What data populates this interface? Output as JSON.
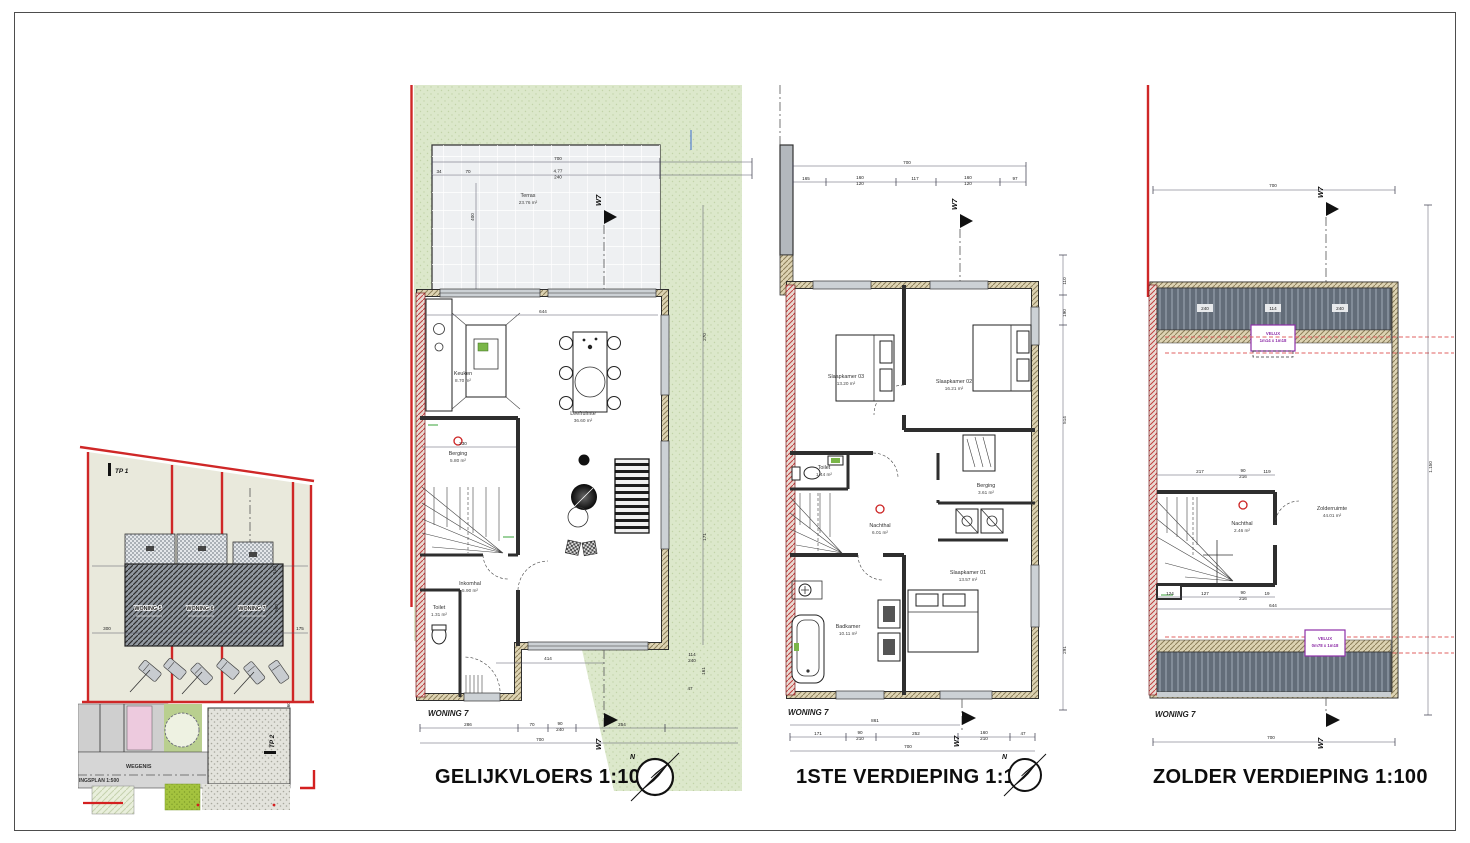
{
  "sheet": {
    "bg": "#ffffff",
    "frame_color": "#4d4d4d"
  },
  "colors": {
    "garden_green": "#dce8cb",
    "terrace_grey": "#eef0f2",
    "wall_hatch": "#ddd3b3",
    "party_wall_red": "#c14040",
    "boundary_red": "#cf2727",
    "roof_grey": "#636d79",
    "velux_purple": "#8e2fa8",
    "site_beige": "#e9e9dc",
    "road_grey": "#d6d6d6",
    "parking_pink": "#edcade",
    "grass_green": "#a4c33e"
  },
  "site_plan": {
    "tp1_label": "TP 1",
    "tp2_label": "TP 2",
    "road_label": "WEGENIS",
    "plan_label": "INGSPLAN 1:500",
    "houses": [
      {
        "label": "WONING 5"
      },
      {
        "label": "WONING 6"
      },
      {
        "label": "WONING 7"
      }
    ],
    "dims": [
      "300",
      "175",
      "960",
      "100",
      "160"
    ]
  },
  "ground_floor": {
    "title": "GELIJKVLOERS  1:100",
    "woning_label": "WONING 7",
    "orientation_marker": "W7",
    "compass_n": "N",
    "rooms": {
      "terras": {
        "name": "Terras",
        "area": "23.76 m²"
      },
      "keuken": {
        "name": "Keuken",
        "area": "8.70 m²"
      },
      "leefruimte": {
        "name": "Leefruimte",
        "area": "36.60 m²"
      },
      "berging": {
        "name": "Berging",
        "area": "5.80 m²"
      },
      "inkomhal": {
        "name": "Inkomhal",
        "area": "5.90 m²"
      },
      "toilet": {
        "name": "Toilet",
        "area": "1.31 m²"
      }
    },
    "dims_top": [
      "700",
      "34",
      "70",
      "4.77",
      "240"
    ],
    "dim_terras_depth": "400",
    "dims_inner": [
      "644",
      "230"
    ],
    "dims_bottom": [
      "414",
      "286",
      "70",
      "90",
      "240",
      "254",
      "700"
    ],
    "dims_right": [
      "114",
      "240",
      "161",
      "47",
      "270",
      "171"
    ]
  },
  "first_floor": {
    "title": "1STE VERDIEPING  1:100",
    "woning_label": "WONING 7",
    "orientation_marker": "W7",
    "compass_n": "N",
    "rooms": {
      "slaapkamer03": {
        "name": "Slaapkamer 03",
        "area": "13.20 m²"
      },
      "slaapkamer02": {
        "name": "Slaapkamer 02",
        "area": "16.21 m²"
      },
      "toilet": {
        "name": "Toilet",
        "area": "1.44 m²"
      },
      "nachthal": {
        "name": "Nachthal",
        "area": "6.01 m²"
      },
      "berging": {
        "name": "Berging",
        "area": "3.61 m²"
      },
      "slaapkamer01": {
        "name": "Slaapkamer 01",
        "area": "13.57 m²"
      },
      "badkamer": {
        "name": "Badkamer",
        "area": "10.11 m²"
      }
    },
    "dims_top": [
      "700",
      "165",
      "160",
      "120",
      "117",
      "160",
      "120",
      "97"
    ],
    "dims_bottom": [
      "861",
      "171",
      "90",
      "210",
      "252",
      "160",
      "210",
      "47",
      "700"
    ],
    "dims_right": [
      "110",
      "190",
      "514",
      "291"
    ]
  },
  "attic_floor": {
    "title": "ZOLDER VERDIEPING  1:100",
    "woning_label": "WONING 7",
    "orientation_marker": "W7",
    "rooms": {
      "zolderruimte": {
        "name": "Zolderruimte",
        "area": "44.01 m²"
      },
      "nachthal": {
        "name": "Nachthal",
        "area": "2.46 m²"
      }
    },
    "velux_top": {
      "line1": "VELUX",
      "line2": "1m14 x 1m18"
    },
    "velux_bottom": {
      "line1": "VELUX",
      "line2": "0m78 x 1m18"
    },
    "dims_top": [
      "700",
      "240",
      "114",
      "240"
    ],
    "dims_inner": [
      "217",
      "90",
      "216",
      "119",
      "124",
      "127",
      "90",
      "216",
      "19",
      "644"
    ],
    "dims_right": [
      "1.150"
    ],
    "dims_bottom": [
      "700"
    ]
  }
}
